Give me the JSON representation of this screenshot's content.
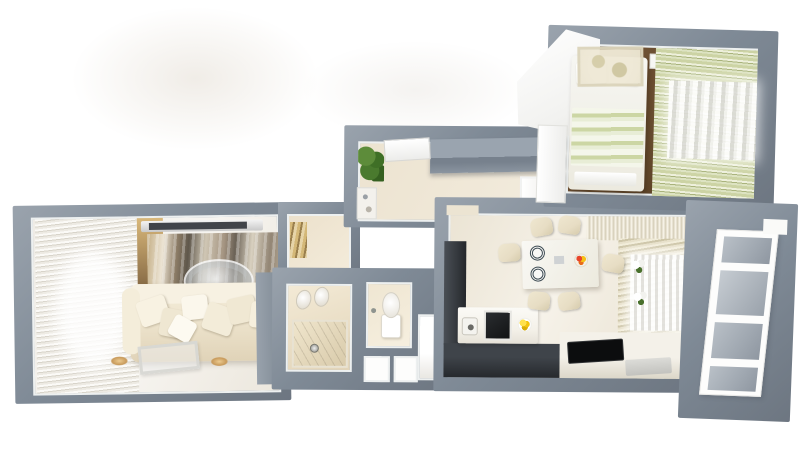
{
  "scene": {
    "label": "3D rendered top-down floor plan of an apartment",
    "type": "3d-floorplan-render"
  },
  "colors": {
    "background": "#ffffff",
    "wall": "#7f8a96",
    "wall_light": "#9aa3ad",
    "wall_dark": "#6d7681",
    "trim": "#edf0f0",
    "floor_light": "#f4f2ec",
    "floor_cream": "#ece3d0",
    "floor_wood": "#64492c",
    "wood_panel": "#8a6d47",
    "sofa": "#efe6d0",
    "art_tan": "#c4ae85",
    "art_dark": "#5f574b",
    "curtain_shadow": "#d8d4ca",
    "curtain_green": "#ccd3a4",
    "curtain_green_dark": "#a9b37c",
    "bed_green": "#ccd6a4",
    "medallion": "#ece6d2",
    "kitchen_dark": "#34383d",
    "appliance_black": "#121314",
    "counter": "#f4f1e9",
    "table": "#f9f8f4",
    "chair": "#e7ddc4",
    "lemon_yellow": "#f2c410",
    "fruit_red": "#e8452a",
    "plant_green": "#4a7a2e",
    "gold": "#c2a468",
    "balcony_pane": "#a0a8b1",
    "white": "#fdfdfc"
  },
  "rooms": [
    {
      "id": "living-room",
      "furniture": [
        "window-curtains",
        "tv",
        "wall-art",
        "pendant-chandelier",
        "sofa",
        "pillows",
        "coffee-table",
        "side-cabinet",
        "floor-lamps"
      ]
    },
    {
      "id": "hallway",
      "furniture": [
        "entry-door",
        "potted-plant",
        "sliding-wardrobe",
        "console-table",
        "white-cabinet"
      ]
    },
    {
      "id": "corridor-nook",
      "furniture": [
        "gold-cabinet"
      ]
    },
    {
      "id": "bathroom",
      "furniture": [
        "double-sink",
        "bathtub",
        "drain"
      ]
    },
    {
      "id": "wc",
      "furniture": [
        "toilet",
        "hygiene-sprayer"
      ]
    },
    {
      "id": "storage",
      "furniture": [
        "closet",
        "closet",
        "utility-door"
      ]
    },
    {
      "id": "kitchen-dining",
      "furniture": [
        "tall-cabinet",
        "base-cabinets",
        "counter",
        "sink",
        "oven",
        "lemon-bowl",
        "cooktop",
        "bench",
        "dining-table",
        "plates",
        "fruit-bowl",
        "six-chairs",
        "window-curtains",
        "flower-pots"
      ]
    },
    {
      "id": "bedroom",
      "furniture": [
        "wardrobe",
        "bed",
        "pillows",
        "striped-duvet",
        "foot-bench",
        "nightstand",
        "ceiling-medallion",
        "window-curtains"
      ]
    },
    {
      "id": "balcony",
      "furniture": [
        "railing",
        "glass-panes",
        "step"
      ]
    }
  ]
}
